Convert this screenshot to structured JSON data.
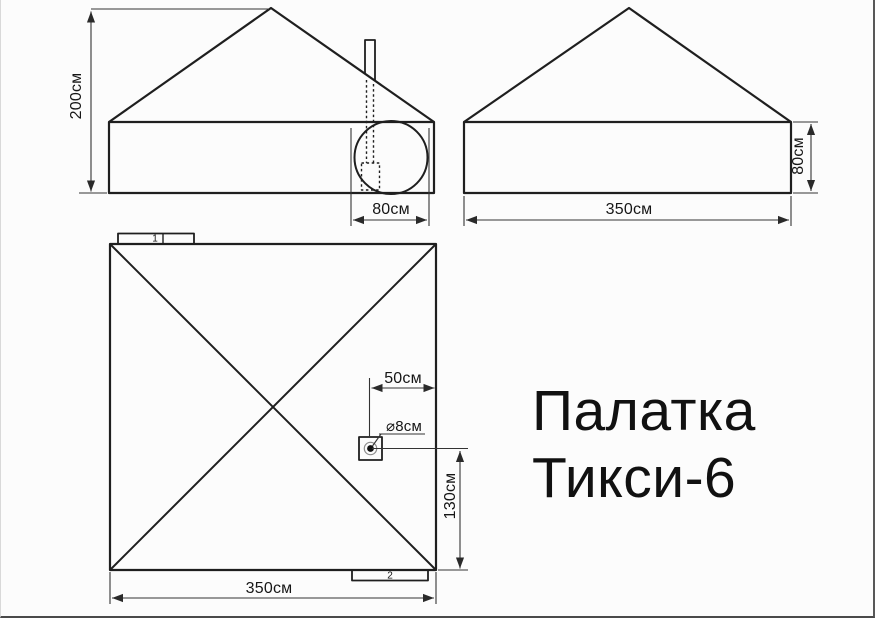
{
  "title": {
    "line1": "Палатка",
    "line2": "Тикси-6"
  },
  "front_view": {
    "height_label": "200см",
    "door_width_label": "80см"
  },
  "side_view": {
    "width_label": "350см",
    "wall_height_label": "80см"
  },
  "plan_view": {
    "width_label": "350см",
    "pipe_offset_right_label": "50см",
    "pipe_hole_diameter_label": "⌀8см",
    "pipe_offset_bottom_label": "130см",
    "tab1_label": "1",
    "tab2_label": "2"
  },
  "colors": {
    "background": "#fcfcfc",
    "outline": "#1f1f1f",
    "dimension": "#333333",
    "text": "#161616"
  }
}
